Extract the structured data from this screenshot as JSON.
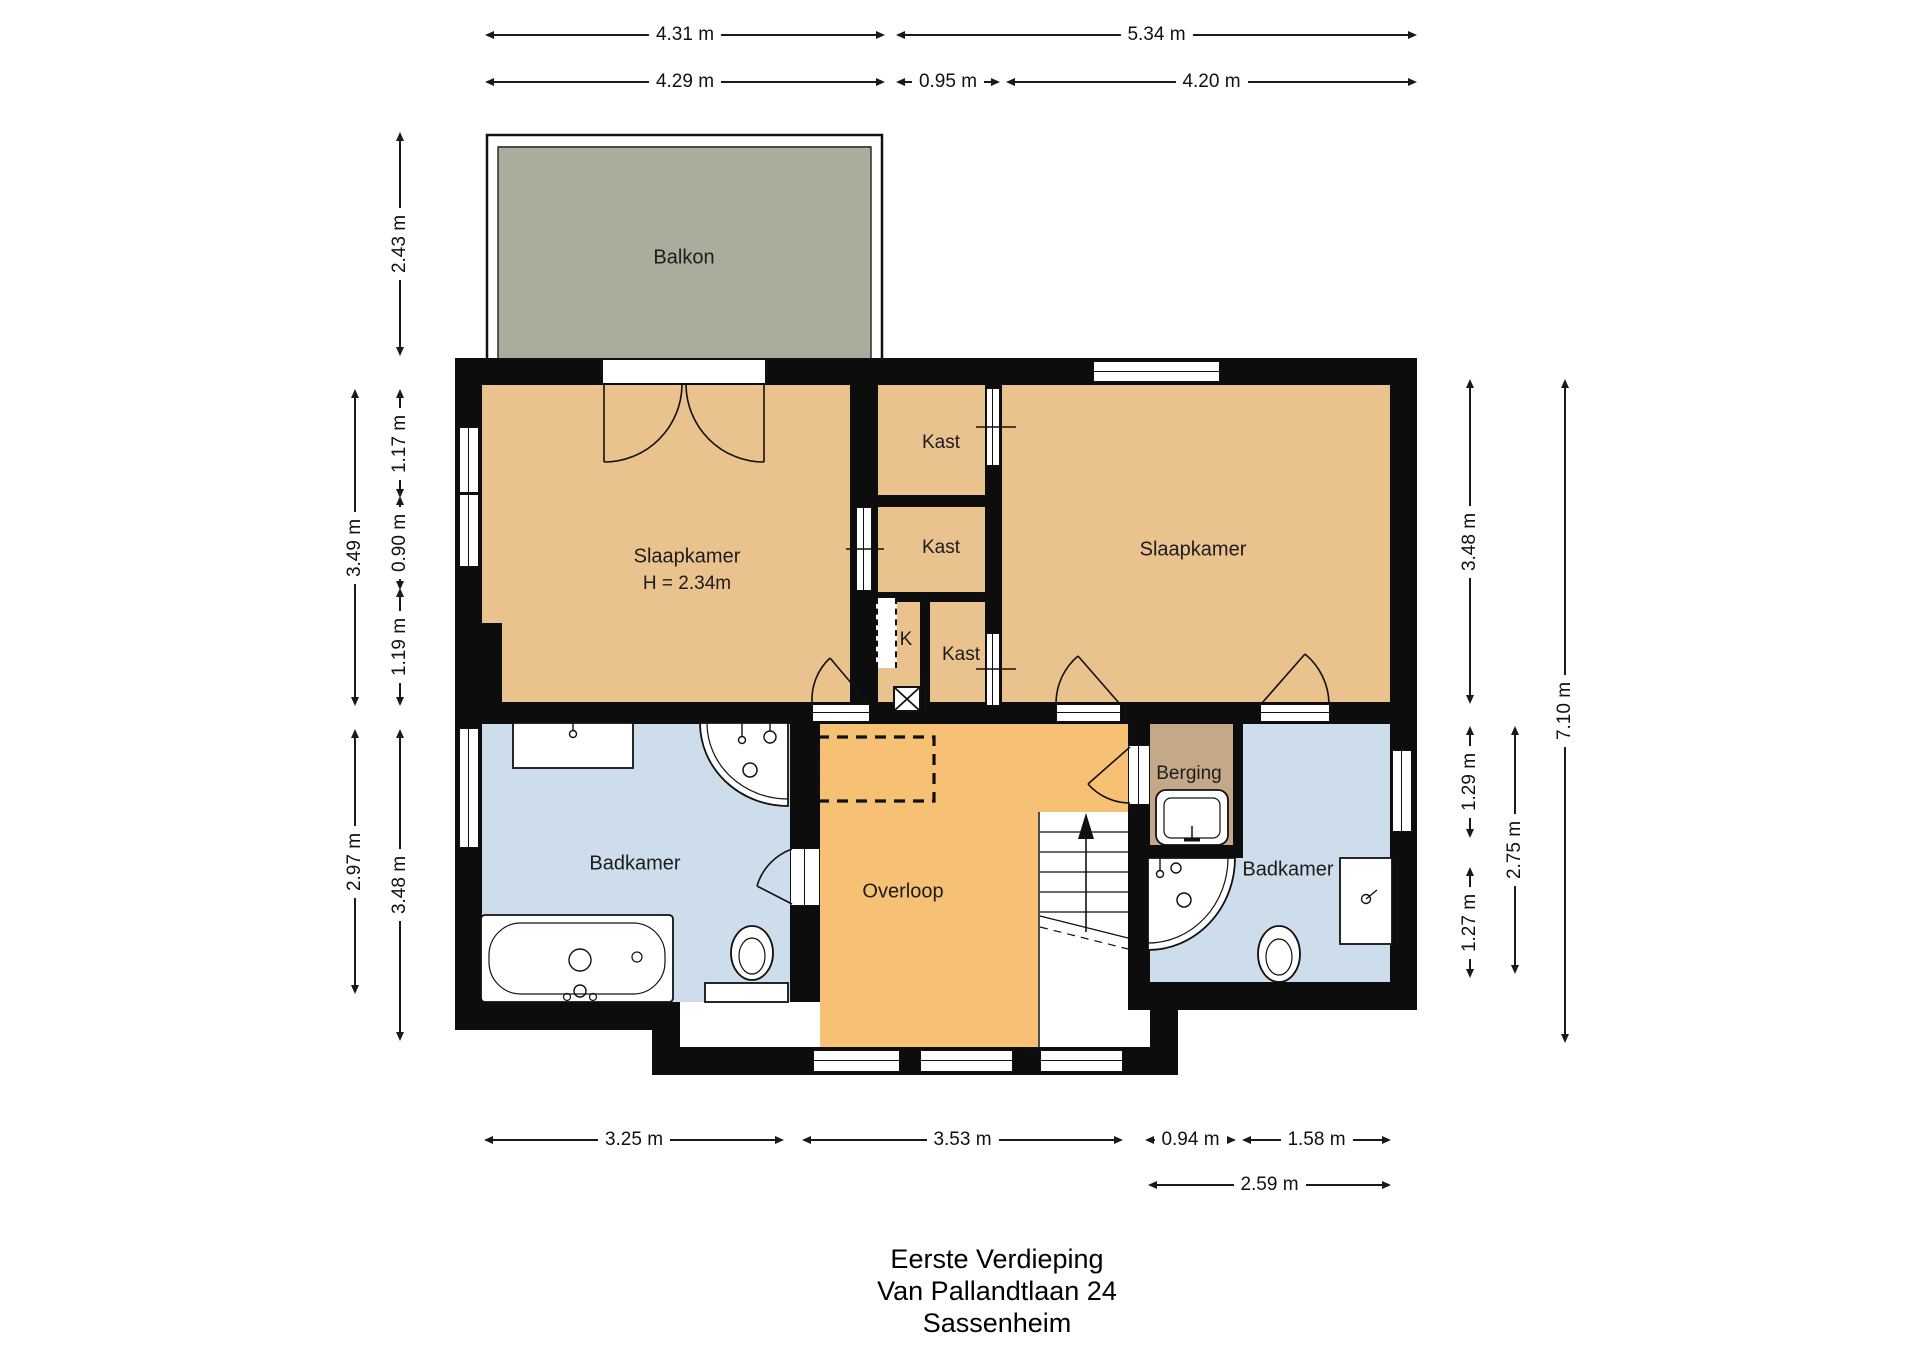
{
  "title": {
    "lines": [
      "Eerste Verdieping",
      "Van Pallandtlaan 24",
      "Sassenheim"
    ]
  },
  "rooms": {
    "balkon": "Balkon",
    "slaapkamer_left": "Slaapkamer",
    "slaapkamer_left_height": "H = 2.34m",
    "kast_top": "Kast",
    "kast_mid": "Kast",
    "kast_bottom": "Kast",
    "k_shaft": "K",
    "slaapkamer_right": "Slaapkamer",
    "badkamer_left": "Badkamer",
    "overloop": "Overloop",
    "berging": "Berging",
    "badkamer_right": "Badkamer"
  },
  "dimensions": {
    "top_row1": [
      "4.31 m",
      "5.34 m"
    ],
    "top_row2": [
      "4.29 m",
      "0.95 m",
      "4.20 m"
    ],
    "left": [
      "2.43 m",
      "3.49 m",
      "1.17 m",
      "0.90 m",
      "1.19 m",
      "2.97 m",
      "3.48 m"
    ],
    "right": [
      "3.48 m",
      "1.29 m",
      "1.27 m",
      "2.75 m",
      "7.10 m"
    ],
    "bottom_row1": [
      "3.25 m",
      "3.53 m",
      "0.94 m",
      "1.58 m"
    ],
    "bottom_row2": [
      "2.59 m"
    ]
  },
  "colors": {
    "wall": "#0d0d0d",
    "room_tan": "#eac28e",
    "overloop_orange": "#f6c175",
    "balkon_green": "#a9ad9b",
    "berging_brown": "#c5a888",
    "badkamer_blue": "#cdddec",
    "fixture_white": "#ffffff"
  }
}
